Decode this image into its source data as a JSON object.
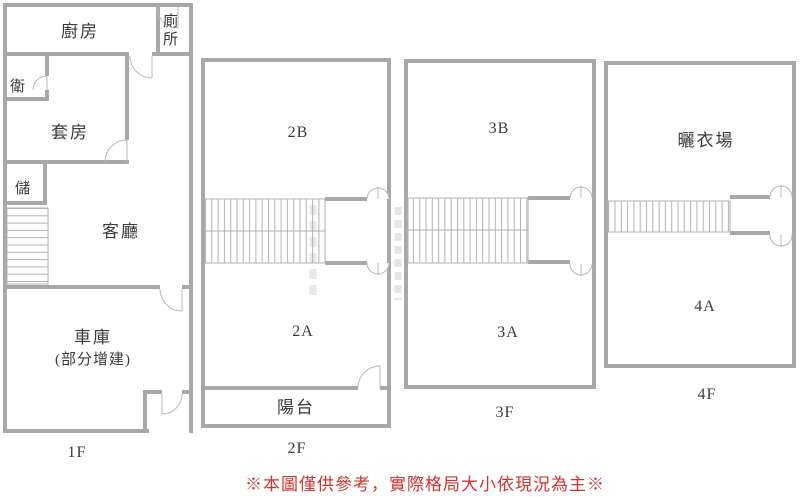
{
  "floors": {
    "f1": {
      "label": "1F",
      "kitchen": "廚房",
      "toilet_l1": "廁",
      "toilet_l2": "所",
      "bath": "衛",
      "suite": "套房",
      "storage": "儲",
      "living": "客廳",
      "garage_l1": "車庫",
      "garage_l2": "(部分增建)"
    },
    "f2": {
      "label": "2F",
      "room_b": "2B",
      "room_a": "2A",
      "balcony": "陽台"
    },
    "f3": {
      "label": "3F",
      "room_b": "3B",
      "room_a": "3A"
    },
    "f4": {
      "label": "4F",
      "drying": "曬衣場",
      "room_a": "4A"
    }
  },
  "disclaimer": "※本圖僅供參考，實際格局大小依現況為主※",
  "colors": {
    "wall": "#a8a8a8",
    "thin_line": "#b3b3b3",
    "text": "#3b3b3b",
    "disclaimer_red": "#d2332e",
    "background": "#ffffff"
  }
}
